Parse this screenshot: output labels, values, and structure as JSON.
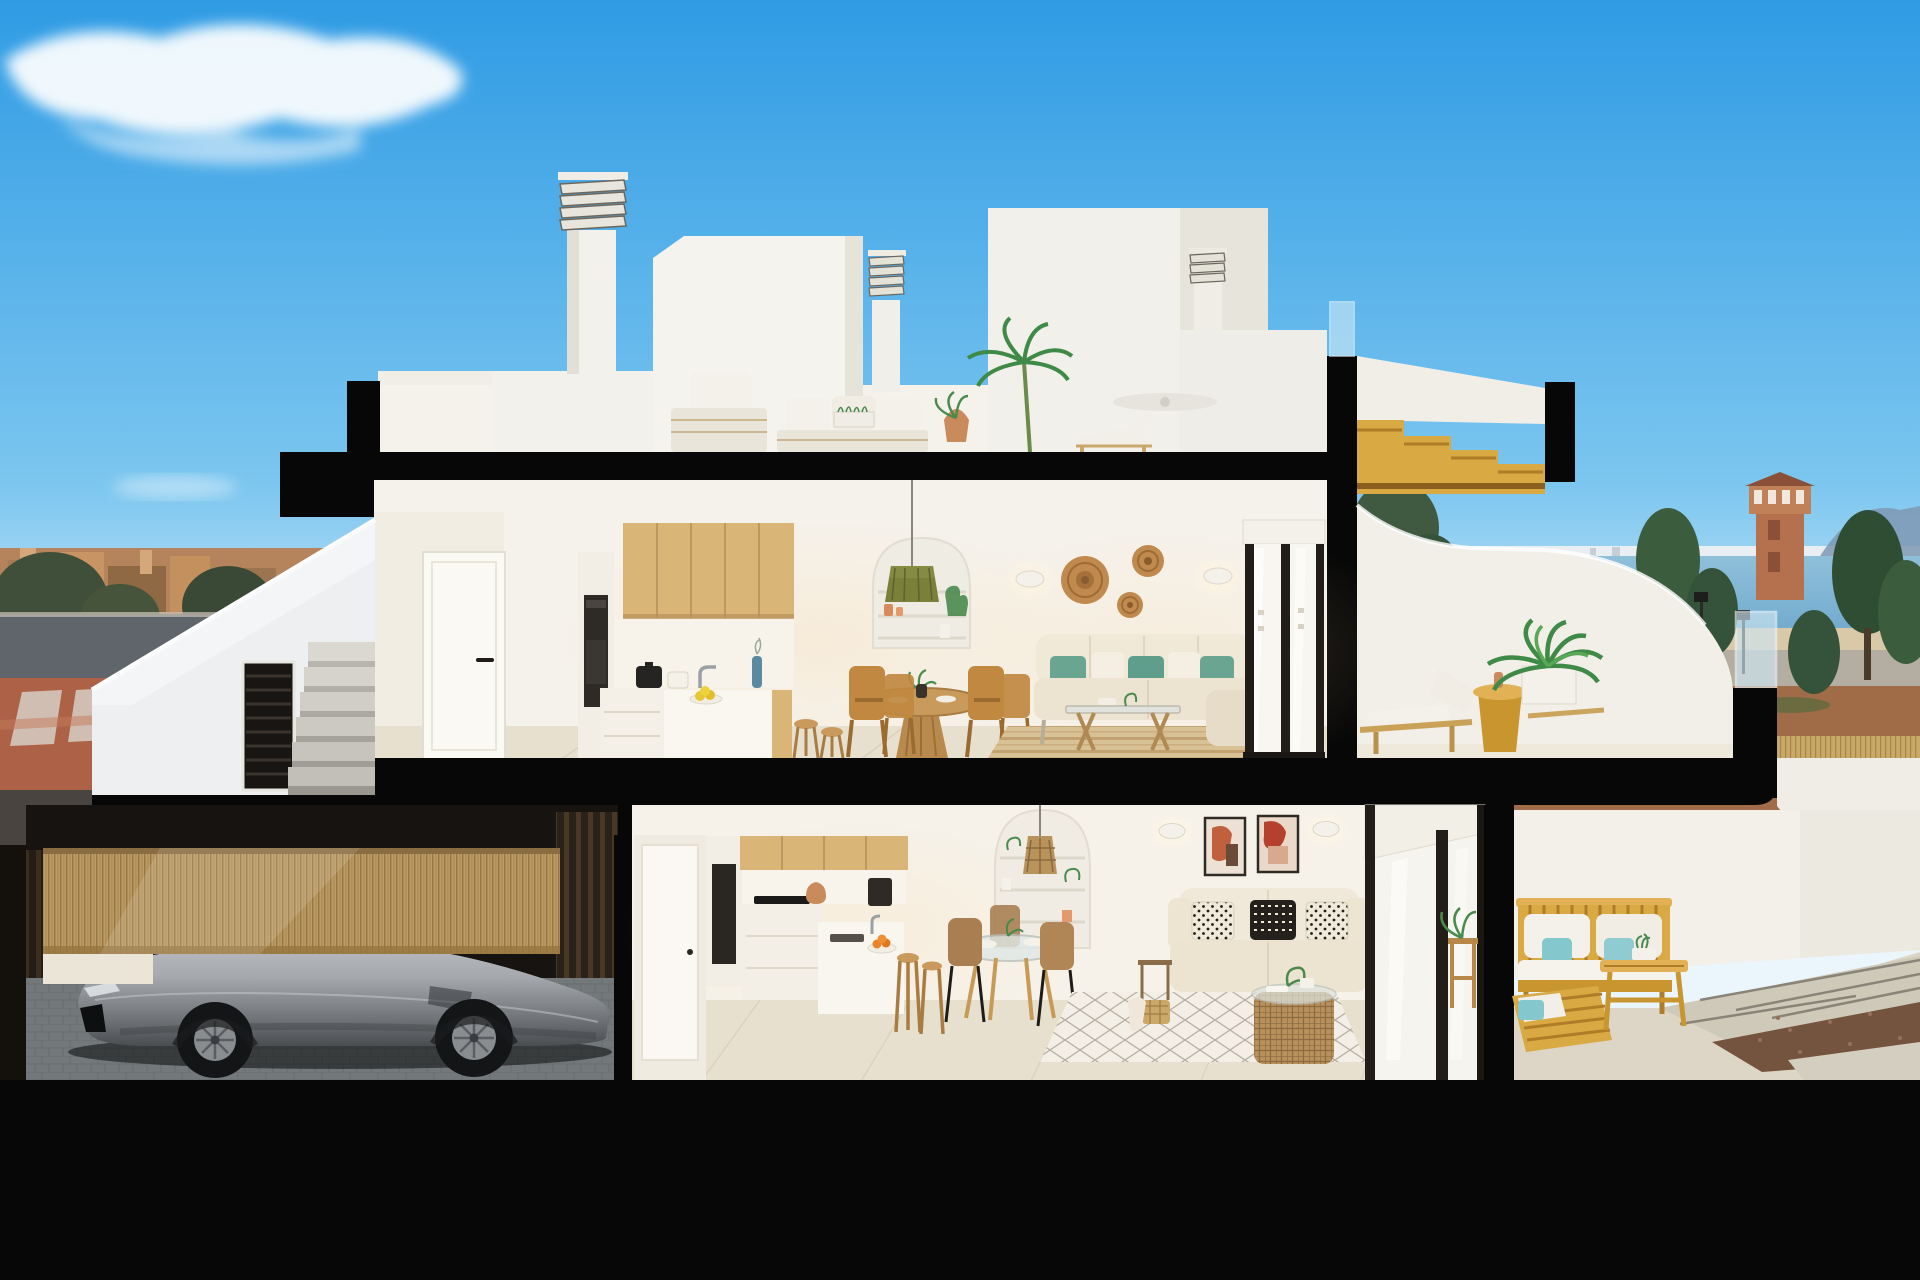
{
  "meta": {
    "kind": "architectural-cross-section-render",
    "width": 1920,
    "height": 1280
  },
  "palette": {
    "sky_top": "#2F9BE4",
    "sky_mid": "#7CC6EF",
    "sky_horizon": "#DDEFFA",
    "cut_black": "#070707",
    "wall_white": "#F5F2EC",
    "wall_shade": "#E9E5DB",
    "cool_white": "#EDEFF1",
    "oak_wood": "#D9B678",
    "oak_dark": "#B8905A",
    "floor_tile": "#E8E0CF",
    "sofa_beige": "#ECE3D0",
    "teal_pillow": "#6AA592",
    "teal_outdoor": "#84C7CC",
    "jute_rug": "#D8C194",
    "gold_wood": "#D9A943",
    "gold_deep": "#B07C28",
    "car_silver": "#A6AAAE",
    "sea": "#72AACD",
    "dirt_field": "#A06C47",
    "tower_terracotta": "#B5714E",
    "tree_green": "#3C5C3E",
    "palm_green": "#3E8A46",
    "dusk_building": "#B5835C",
    "sidewalk_red": "#AD6248",
    "road_gray": "#5F656A",
    "bamboo_fence": "#BB9C68",
    "garage_dark": "#171310",
    "paver_gray": "#9AA0A4",
    "glazing": "#F8F6F0",
    "frame_dark": "#221D19",
    "wicker": "#C08A4E",
    "terracotta_pot": "#C98A5C",
    "olive_lamp": "#7A7F3A",
    "art_rust": "#C0603C"
  },
  "scene": {
    "sky": {
      "elements": [
        "gradient-sky",
        "wispy-cloud"
      ]
    },
    "background_left": {
      "elements": [
        "dusk-town-skyline",
        "street",
        "red-sidewalk-crosswalk",
        "traffic-sign",
        "trees"
      ]
    },
    "background_right": {
      "elements": [
        "sea-horizon",
        "distant-skyline",
        "mountains",
        "watchtower",
        "conifer-trees",
        "reed-fence",
        "dirt-field",
        "street-lamps"
      ]
    },
    "rooftop": {
      "elements": [
        "parapets",
        "louvered-chimneys",
        "roof-volumes",
        "outdoor-sofa",
        "armchair",
        "potted-palm",
        "sun-lounger"
      ]
    },
    "upper_floor": {
      "elements": [
        "hallway-door",
        "oak-kitchen",
        "island-with-stools",
        "round-dining-table",
        "arched-niche",
        "olive-pendant-lamp",
        "wicker-wall-discs",
        "wall-sconces",
        "beige-sofa-teal-cushions",
        "glass-coffee-table",
        "jute-rug",
        "sliding-glass-door",
        "terrace-loungers",
        "gold-side-table",
        "potted-palm",
        "wood-stair-pergola",
        "curved-parapet"
      ]
    },
    "lower_floor": {
      "elements": [
        "garage-with-sports-car",
        "bamboo-facade",
        "oak-kitchen",
        "peninsula-stools",
        "glass-dining-table",
        "arched-niche",
        "wicker-pendant",
        "framed-abstract-art",
        "sofa-patterned-pillows",
        "rattan-coffee-table",
        "diamond-rug",
        "sliding-glass-door",
        "outdoor-gold-wood-sofa-set",
        "gravel-and-pavers"
      ]
    },
    "structure": {
      "elements": [
        "black-cut-slabs",
        "black-cut-walls",
        "base-slab"
      ]
    }
  }
}
